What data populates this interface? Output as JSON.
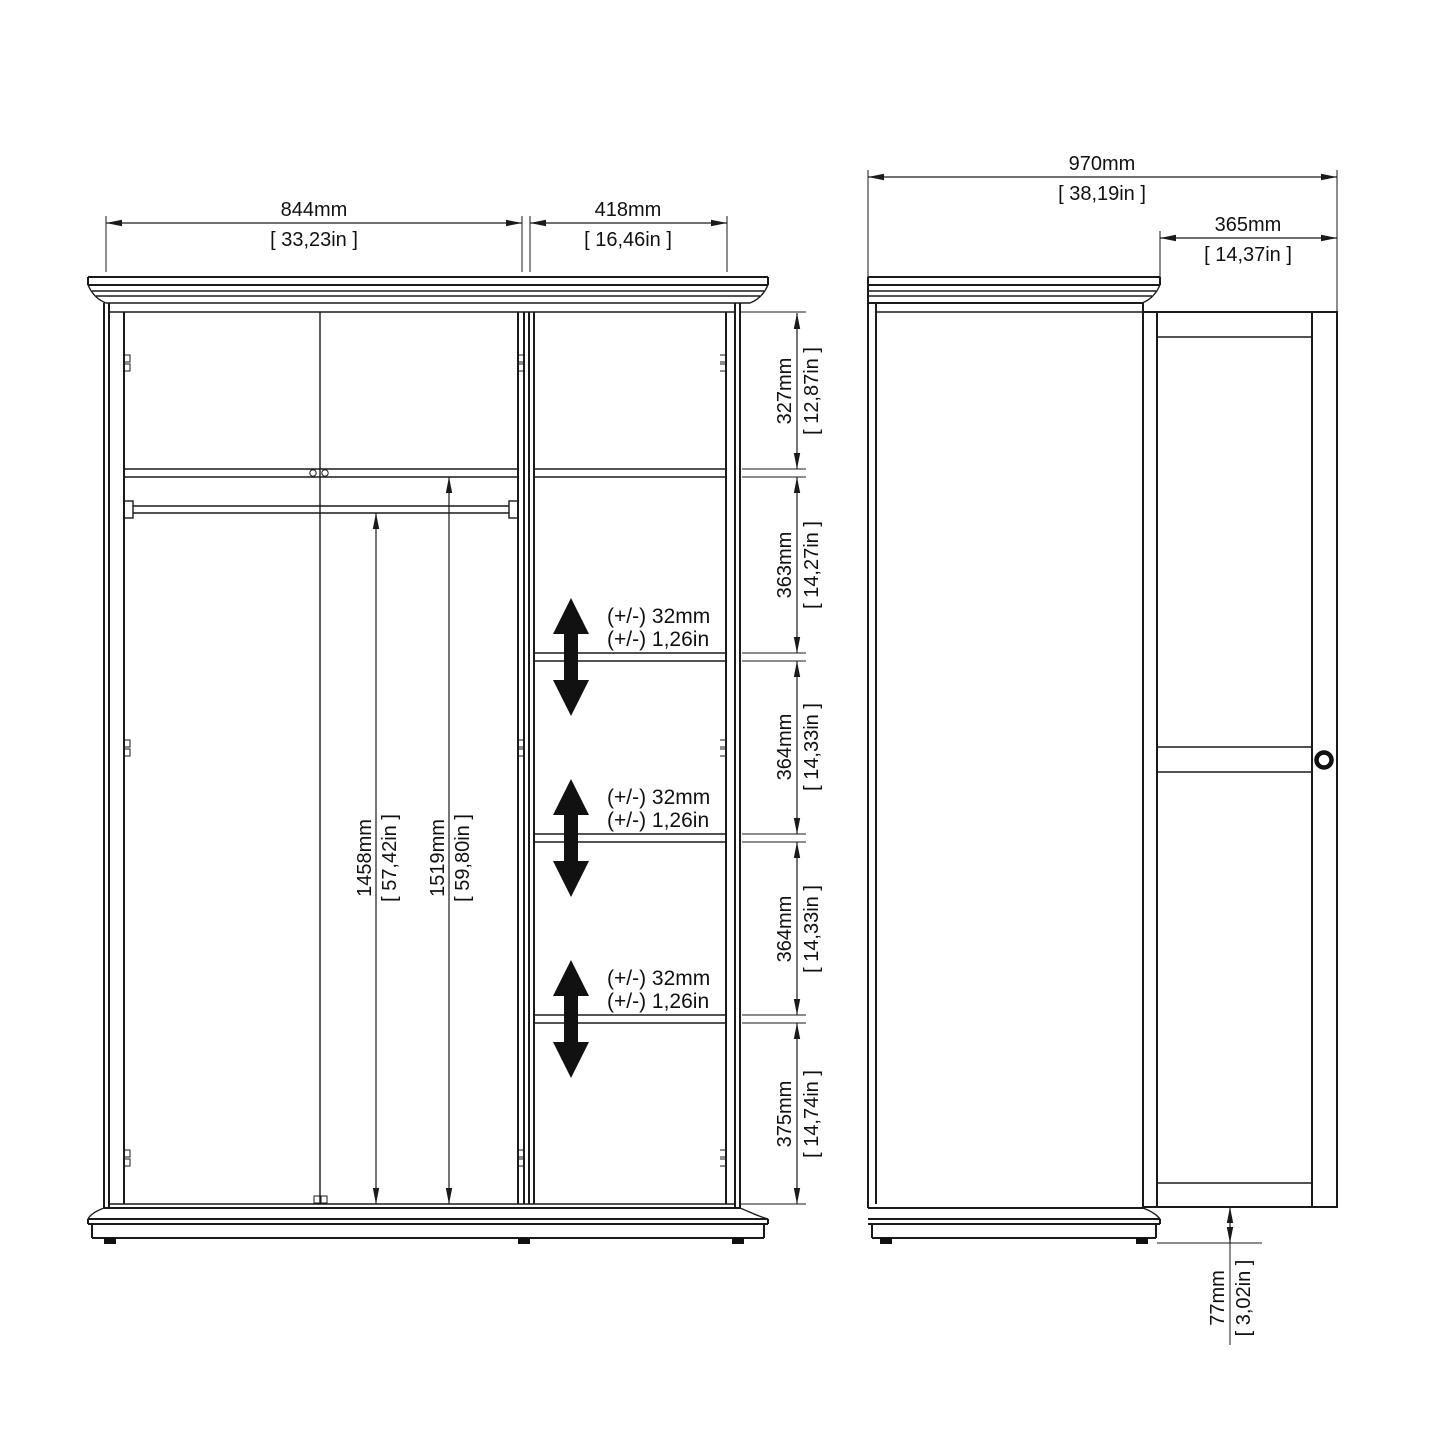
{
  "drawing": {
    "front_view": {
      "dims": {
        "width_left": {
          "mm": "844mm",
          "inch": "[ 33,23in ]"
        },
        "width_right": {
          "mm": "418mm",
          "inch": "[ 16,46in ]"
        },
        "rail_height": {
          "mm": "1458mm",
          "inch": "[ 57,42in ]"
        },
        "interior_height": {
          "mm": "1519mm",
          "inch": "[ 59,80in ]"
        },
        "sections": [
          {
            "mm": "327mm",
            "inch": "[ 12,87in ]"
          },
          {
            "mm": "363mm",
            "inch": "[ 14,27in ]"
          },
          {
            "mm": "364mm",
            "inch": "[ 14,33in ]"
          },
          {
            "mm": "364mm",
            "inch": "[ 14,33in ]"
          },
          {
            "mm": "375mm",
            "inch": "[ 14,74in ]"
          }
        ],
        "adjustable": {
          "mm": "(+/-) 32mm",
          "inch": "(+/-) 1,26in"
        }
      }
    },
    "side_view": {
      "dims": {
        "depth_total": {
          "mm": "970mm",
          "inch": "[ 38,19in ]"
        },
        "door_width": {
          "mm": "365mm",
          "inch": "[ 14,37in ]"
        },
        "plinth_height": {
          "mm": "77mm",
          "inch": "[ 3,02in ]"
        }
      }
    }
  }
}
